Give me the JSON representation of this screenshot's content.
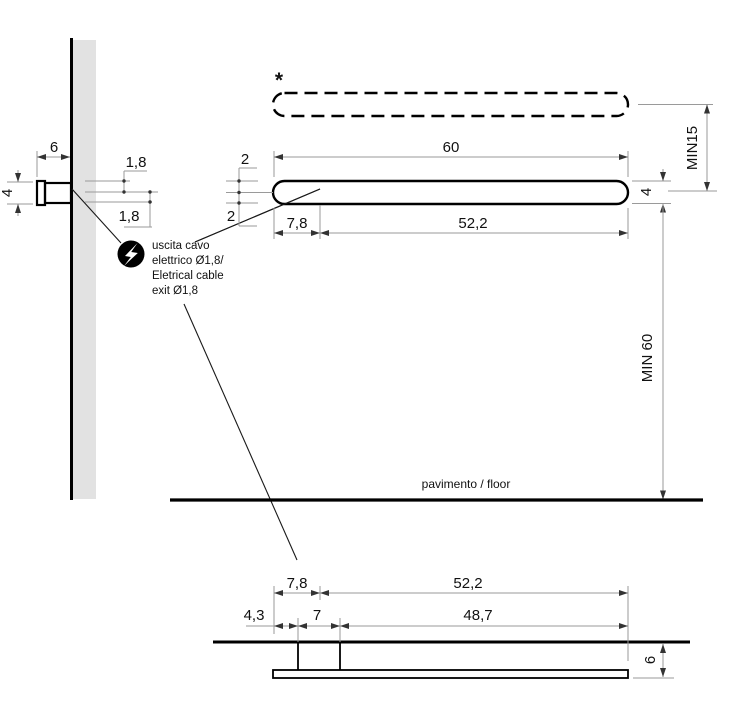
{
  "note": {
    "line1": "uscita cavo",
    "line2": "elettrico Ø1,8/",
    "line3": "Eletrical cable",
    "line4": "exit Ø1,8"
  },
  "side_view": {
    "depth": "6",
    "height": "4",
    "cable_dia_upper": "1,8",
    "cable_dia_lower": "1,8"
  },
  "front_view": {
    "asterisk": "*",
    "width": "60",
    "cable_offset": "7,8",
    "body_width": "52,2",
    "upper_half": "2",
    "lower_half": "2",
    "height": "4",
    "min_top": "MIN15",
    "min_floor": "MIN 60",
    "floor_label": "pavimento / floor"
  },
  "bottom_view": {
    "cable_offset": "7,8",
    "body_width": "52,2",
    "edge_to_bracket": "4,3",
    "bracket_width": "7",
    "bracket_to_end": "48,7",
    "thickness": "6"
  },
  "colors": {
    "outline": "#000000",
    "dimension": "#9a9a9a",
    "wall_fill": "#e2e2e2",
    "text": "#111111",
    "icon_bg": "#000000",
    "icon_bolt": "#ffffff"
  }
}
